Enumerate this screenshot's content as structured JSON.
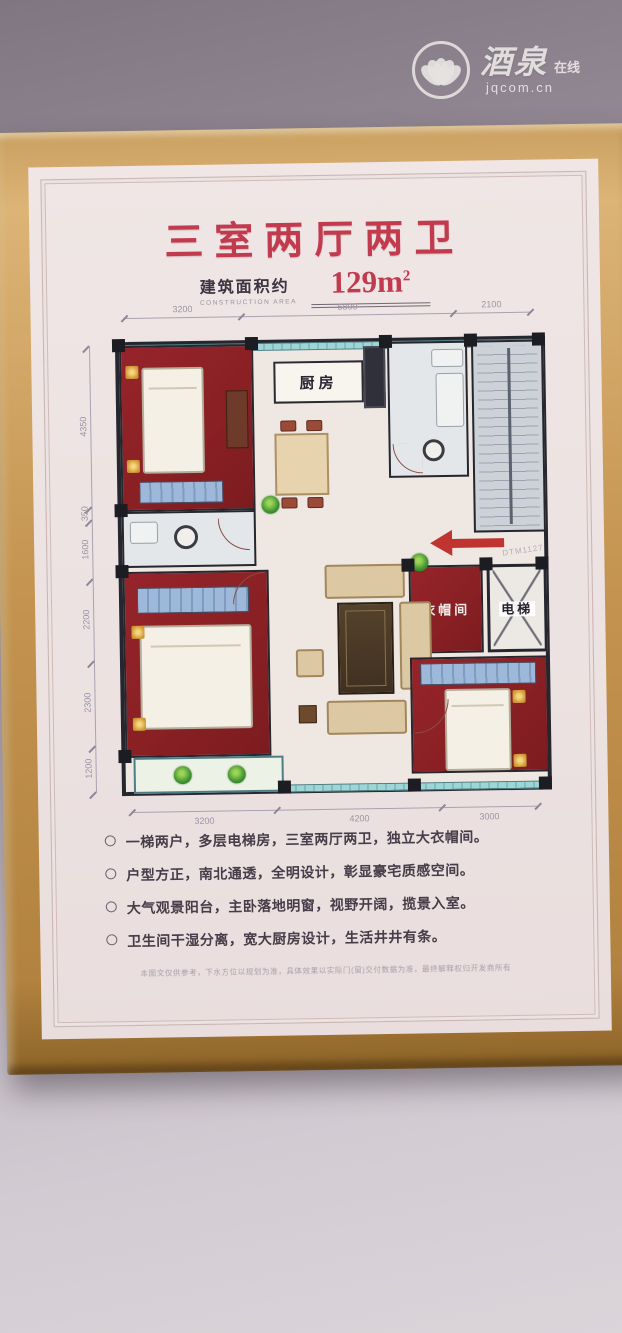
{
  "watermark": {
    "brand": "酒泉",
    "tagline": "在线",
    "domain": "jqcom.cn",
    "logo": "lotus-ring-icon"
  },
  "poster": {
    "title": "三室两厅两卫",
    "area_label_cn": "建筑面积约",
    "area_label_en": "CONSTRUCTION AREA",
    "area_value": "129m",
    "area_sup": "2"
  },
  "plan": {
    "rooms": {
      "kitchen": "厨房",
      "cloakroom": "衣帽间",
      "elevator": "电梯"
    },
    "entry_code": "DTM1127",
    "dims_top": [
      "3200",
      "5800",
      "2100"
    ],
    "dims_left": [
      "4350",
      "350",
      "1600",
      "2200",
      "2300",
      "1200"
    ],
    "dims_bottom": [
      "3200",
      "4200",
      "3000"
    ]
  },
  "features": {
    "items": [
      "一梯两户，多层电梯房，三室两厅两卫，独立大衣帽间。",
      "户型方正，南北通透，全明设计，彰显豪宅质感空间。",
      "大气观景阳台，主卧落地明窗，视野开阔，揽景入室。",
      "卫生间干湿分离，宽大厨房设计，生活井井有条。"
    ]
  },
  "footnote": {
    "text": "本图文仅供参考，下水方位以规划为准，具体效果以实际门(窗)交付数据为准，最终解释权归开发商所有"
  },
  "colors": {
    "accent_red": "#c23a4d",
    "bedroom_red": "#8e2126",
    "window_teal": "#9ed6d6",
    "frame_gold": "#c3934f"
  }
}
